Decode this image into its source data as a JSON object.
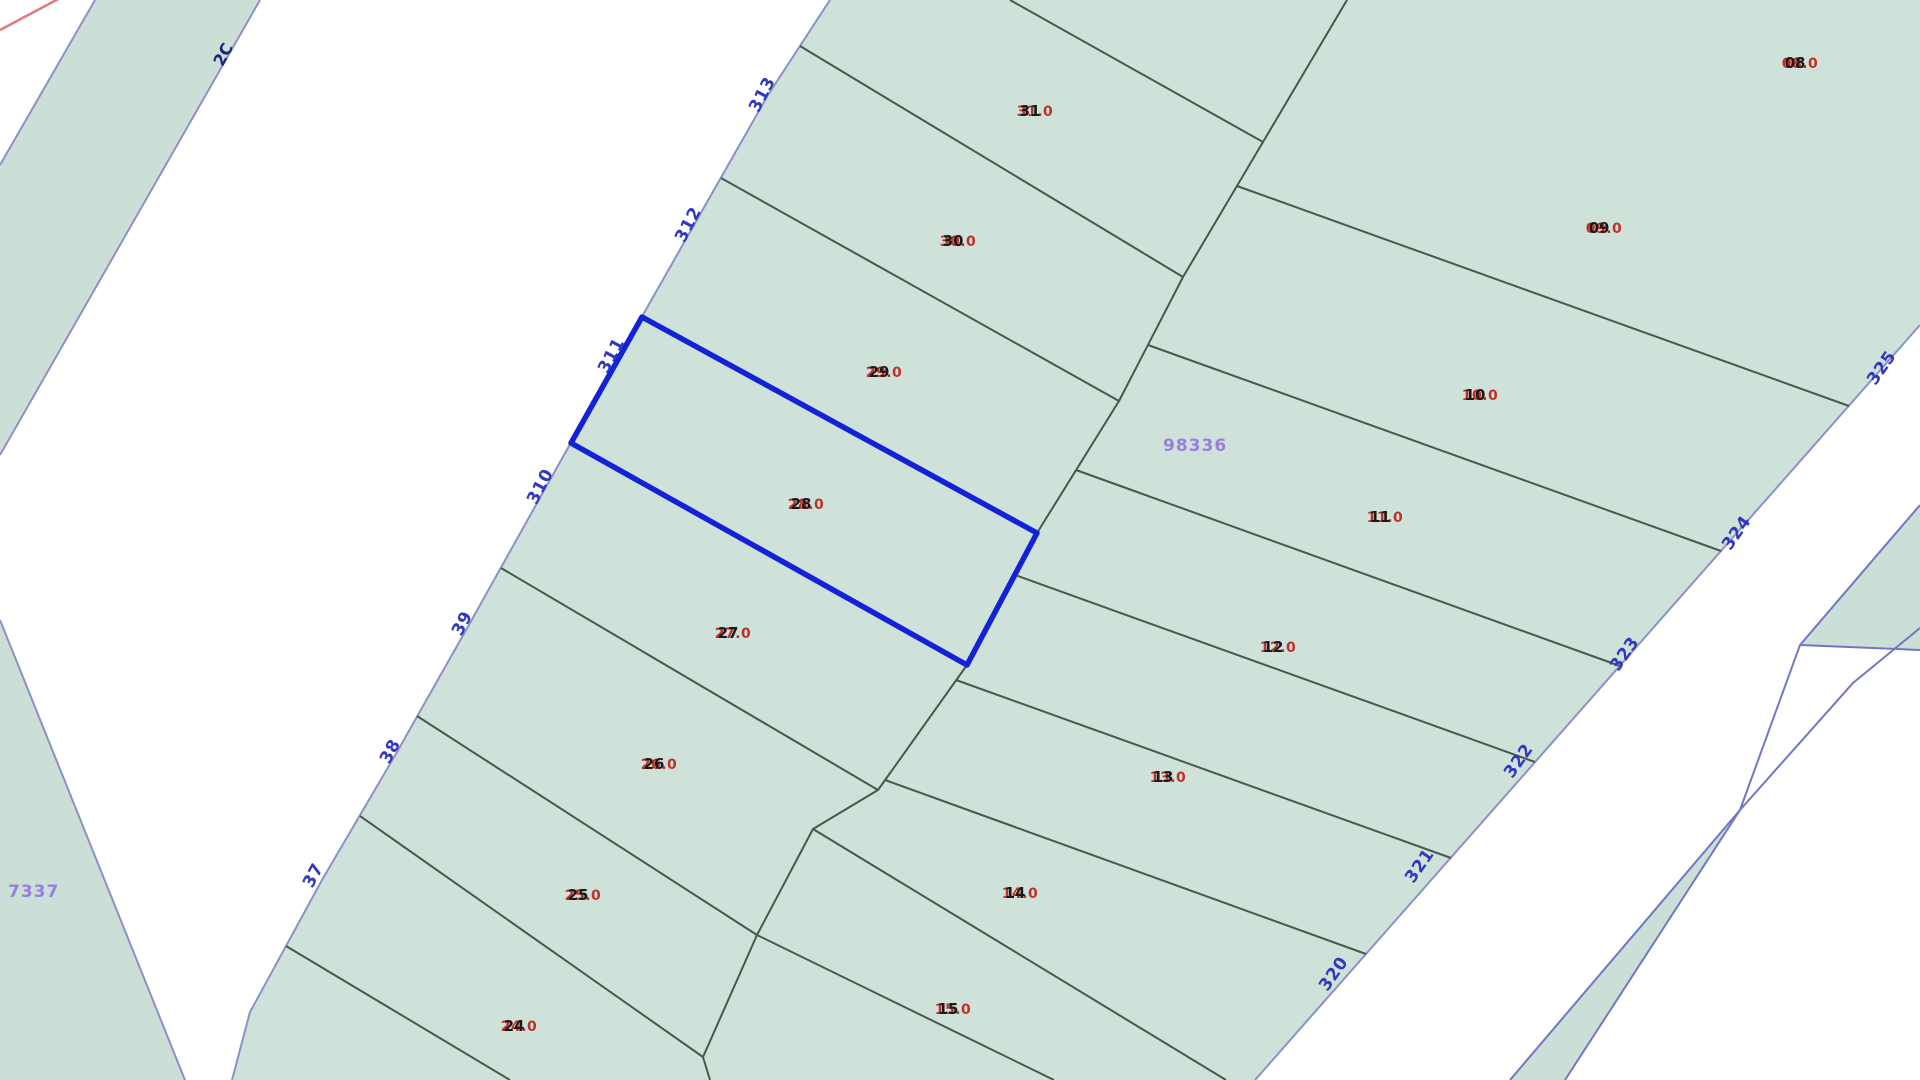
{
  "app": {
    "title": "cadastral-parcel-map"
  },
  "map": {
    "colors": {
      "background": "#ffffff",
      "parcel_fill": "#cfe2d9",
      "parcel_fill_alt": "#cbdfd6",
      "divider_line": "#47594f",
      "road_edge_line": "#8d90c6",
      "sliver_edge_line": "#7077c4",
      "selected_outline": "#1322d6",
      "red_label": "#c03028",
      "black_label": "#191919",
      "blue_label": "#3038c0",
      "navy_label": "#1d2478",
      "purple_label": "#9b7de0",
      "red_boundary": "#e07878"
    },
    "selected_parcel": "28",
    "road_point_labels": [
      {
        "text": "313",
        "x": 767,
        "y": 97,
        "rot": -62
      },
      {
        "text": "312",
        "x": 693,
        "y": 227,
        "rot": -62
      },
      {
        "text": "311",
        "x": 616,
        "y": 358,
        "rot": -62
      },
      {
        "text": "310",
        "x": 545,
        "y": 489,
        "rot": -62
      },
      {
        "text": "39",
        "x": 467,
        "y": 626,
        "rot": -62
      },
      {
        "text": "38",
        "x": 395,
        "y": 754,
        "rot": -62
      },
      {
        "text": "37",
        "x": 318,
        "y": 878,
        "rot": -62
      },
      {
        "text": "325",
        "x": 1886,
        "y": 371,
        "rot": -55
      },
      {
        "text": "324",
        "x": 1741,
        "y": 536,
        "rot": -55
      },
      {
        "text": "323",
        "x": 1629,
        "y": 657,
        "rot": -55
      },
      {
        "text": "322",
        "x": 1523,
        "y": 764,
        "rot": -55
      },
      {
        "text": "321",
        "x": 1424,
        "y": 869,
        "rot": -55
      },
      {
        "text": "320",
        "x": 1338,
        "y": 977,
        "rot": -55
      }
    ],
    "corner_label": {
      "text": "2C",
      "x": 228,
      "y": 57,
      "rot": -62
    },
    "parcel_labels": [
      {
        "number": "31",
        "area": "31.0",
        "x": 1035,
        "y": 116
      },
      {
        "number": "30",
        "area": "30.0",
        "x": 958,
        "y": 246
      },
      {
        "number": "29",
        "area": "29.0",
        "x": 884,
        "y": 377
      },
      {
        "number": "28",
        "area": "28.0",
        "x": 806,
        "y": 509
      },
      {
        "number": "27",
        "area": "27.0",
        "x": 733,
        "y": 638
      },
      {
        "number": "26",
        "area": "26.0",
        "x": 659,
        "y": 769
      },
      {
        "number": "25",
        "area": "25.0",
        "x": 583,
        "y": 900
      },
      {
        "number": "24",
        "area": "24.0",
        "x": 519,
        "y": 1031
      },
      {
        "number": "08",
        "area": "08.0",
        "x": 1800,
        "y": 68
      },
      {
        "number": "09",
        "area": "09.0",
        "x": 1604,
        "y": 233
      },
      {
        "number": "10",
        "area": "10.0",
        "x": 1480,
        "y": 400
      },
      {
        "number": "11",
        "area": "11.0",
        "x": 1385,
        "y": 522
      },
      {
        "number": "12",
        "area": "12.0",
        "x": 1278,
        "y": 652
      },
      {
        "number": "13",
        "area": "13.0",
        "x": 1168,
        "y": 782
      },
      {
        "number": "14",
        "area": "14.0",
        "x": 1020,
        "y": 898
      },
      {
        "number": "15",
        "area": "15.0",
        "x": 953,
        "y": 1014
      }
    ],
    "zone_labels": [
      {
        "text": "98336",
        "x": 1163,
        "y": 451
      },
      {
        "text": "7337",
        "x": 8,
        "y": 897
      }
    ]
  }
}
